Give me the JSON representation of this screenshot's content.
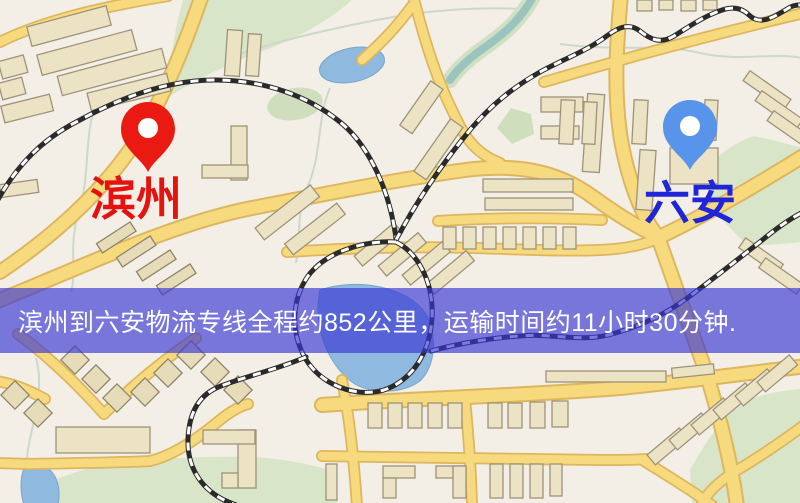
{
  "banner": {
    "text": "滨州到六安物流专线全程约852公里，运输时间约11小时30分钟.",
    "distance_km": "852",
    "duration": "11小时30分钟",
    "background": "rgba(56,54,213,0.66)",
    "text_color": "#ffffff"
  },
  "markers": {
    "origin": {
      "label": "滨州",
      "label_color": "#e41310",
      "pin_color": "#ea1a12",
      "pin_icon": "map-pin"
    },
    "destination": {
      "label": "六安",
      "label_color": "#2125d8",
      "pin_color": "#5794ea",
      "pin_icon": "map-pin"
    }
  },
  "map": {
    "theme": {
      "background": "#f3efe6",
      "road_fill": "#f8da7e",
      "road_casing": "#ddb660",
      "building_fill": "#ece2c4",
      "building_stroke": "#9e9379",
      "park": "#d8e5c8",
      "water": "#8fb9de",
      "railway": "#2a2a2a"
    }
  }
}
